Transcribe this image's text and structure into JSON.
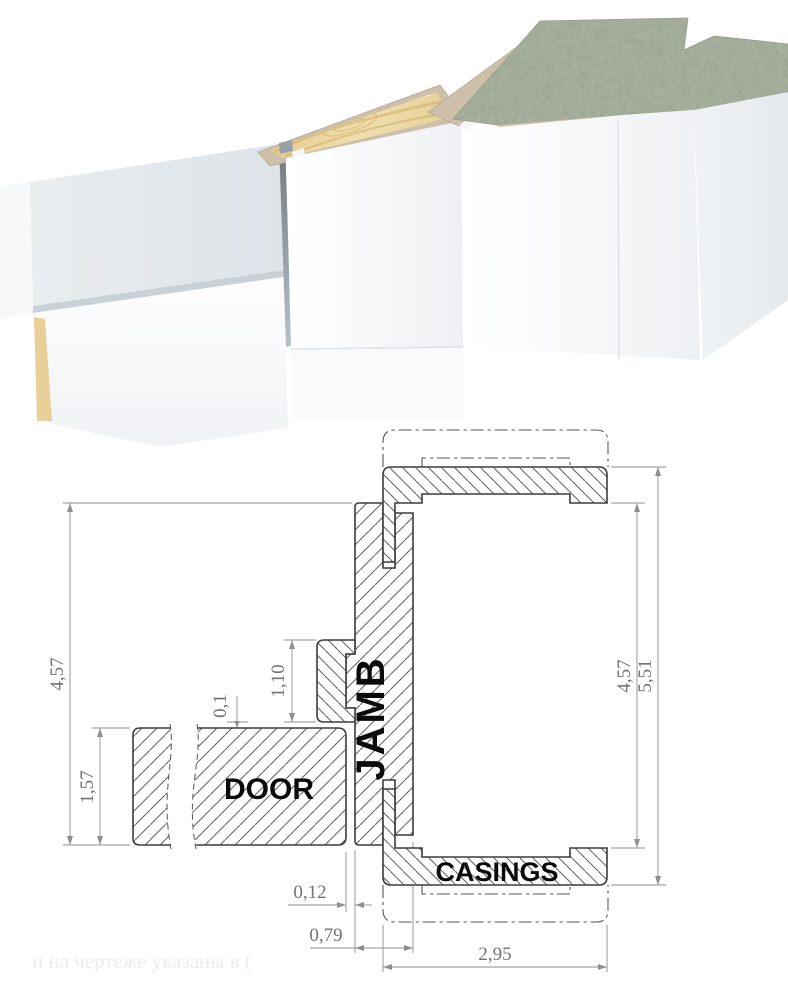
{
  "drawing": {
    "labels": {
      "door": "DOOR",
      "jamb": "JAMB",
      "casings": "CASINGS"
    },
    "dimensions": {
      "jamb_length_left": "4,57",
      "door_thickness": "1,57",
      "stop_height": "1,10",
      "door_gap": "0,1",
      "door_clearance": "0,12",
      "jamb_thickness": "0,79",
      "casing_width": "2,95",
      "opening_right": "4,57",
      "overall_right": "5,51"
    },
    "watermark": "и на чертеже указаны в ("
  },
  "colors": {
    "outline": "#3c3c3c",
    "hatch": "#5f5f5f",
    "dimension": "#8f8f8f",
    "dimension_text": "#737373",
    "label_text": "#0b0b0b",
    "wood": "#e9d49c",
    "tan_profile": "#cdbfa9",
    "marble_green": "#96a18b",
    "panel_white": "#f7f9fa"
  }
}
